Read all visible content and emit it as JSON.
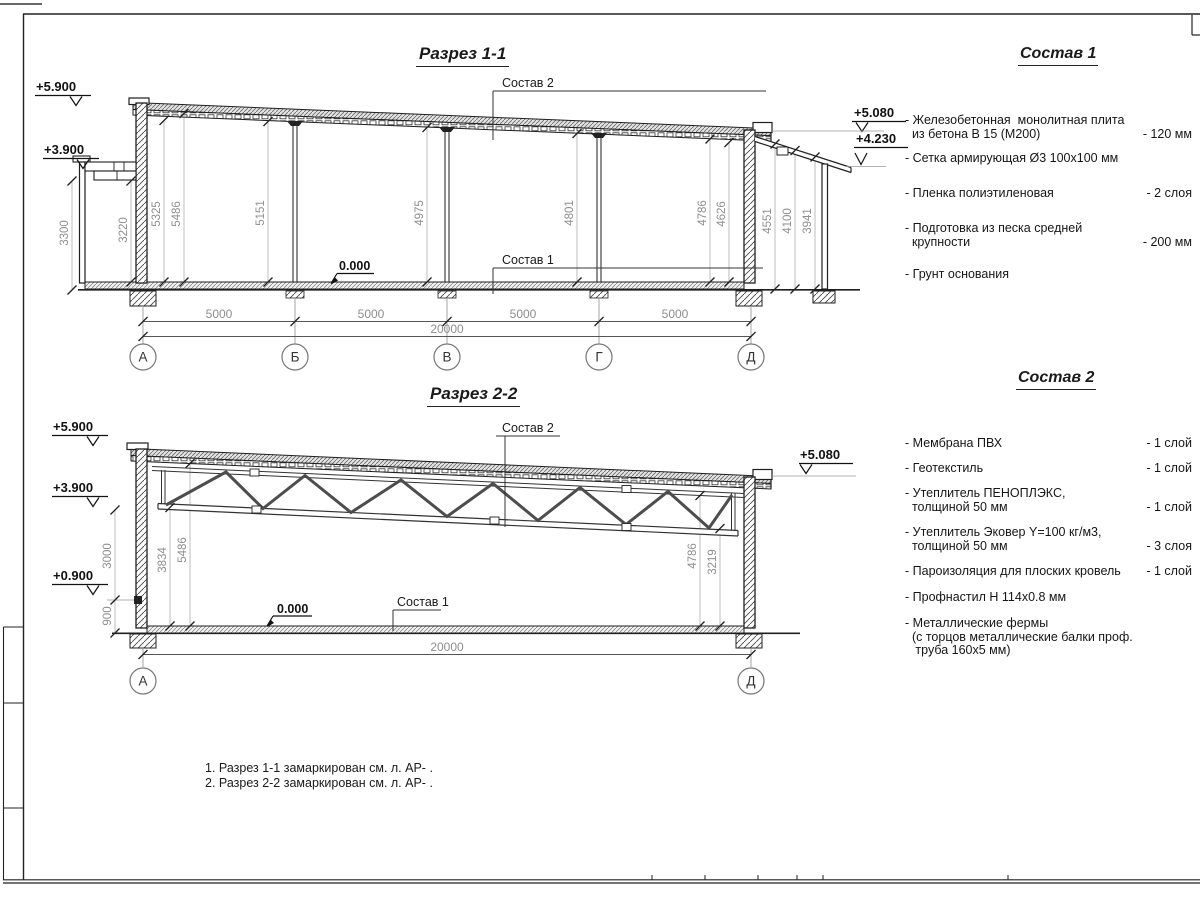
{
  "sheet": {
    "section1": {
      "title": "Разрез 1-1",
      "label_sostav2": "Состав 2",
      "label_sostav1": "Состав 1",
      "zero_mark": "0.000",
      "elevations": [
        "+5.900",
        "+3.900",
        "+5.080",
        "+4.230"
      ],
      "dims_v": [
        "3300",
        "3220",
        "5325",
        "5486",
        "5151",
        "4975",
        "4801",
        "4786",
        "4626",
        "4551",
        "4100",
        "3941"
      ],
      "dims_h": [
        "5000",
        "5000",
        "5000",
        "5000"
      ],
      "dim_total": "20000",
      "axes": [
        "А",
        "Б",
        "В",
        "Г",
        "Д"
      ]
    },
    "section2": {
      "title": "Разрез 2-2",
      "label_sostav2": "Состав 2",
      "label_sostav1": "Состав 1",
      "zero_mark": "0.000",
      "elevations": [
        "+5.900",
        "+3.900",
        "+0.900",
        "+5.080"
      ],
      "dims_v": [
        "3000",
        "900",
        "3834",
        "5486",
        "4786",
        "3219"
      ],
      "dim_total": "20000",
      "axes": [
        "А",
        "Д"
      ]
    },
    "sostav1": {
      "title": "Состав 1",
      "items": [
        {
          "name": "- Железобетонная  монолитная плита\n  из бетона В 15 (М200)",
          "value": "- 120 мм"
        },
        {
          "name": "- Сетка армирующая Ø3 100х100 мм",
          "value": ""
        },
        {
          "name": "- Пленка полиэтиленовая",
          "value": "-  2 слоя"
        },
        {
          "name": "- Подготовка из песка средней\n  крупности",
          "value": "- 200 мм"
        },
        {
          "name": "- Грунт основания",
          "value": ""
        }
      ]
    },
    "sostav2": {
      "title": "Состав 2",
      "items": [
        {
          "name": "- Мембрана ПВХ",
          "value": "- 1 слой"
        },
        {
          "name": "- Геотекстиль",
          "value": "- 1 слой"
        },
        {
          "name": "- Утеплитель ПЕНОПЛЭКС,\n  толщиной 50 мм",
          "value": "- 1 слой"
        },
        {
          "name": "- Утеплитель Эковер Y=100 кг/м3,\n  толщиной 50 мм",
          "value": "- 3 слоя"
        },
        {
          "name": "- Пароизоляция для плоских кровель",
          "value": "- 1 слой"
        },
        {
          "name": "- Профнастил Н 114х0.8 мм",
          "value": ""
        },
        {
          "name": "- Металлические фермы\n  (с торцов металлические балки проф.\n   труба 160х5 мм)",
          "value": ""
        }
      ]
    },
    "notes": [
      "1. Разрез 1-1 замаркирован см. л. АР- .",
      "2. Разрез 2-2 замаркирован см. л. АР- ."
    ]
  }
}
